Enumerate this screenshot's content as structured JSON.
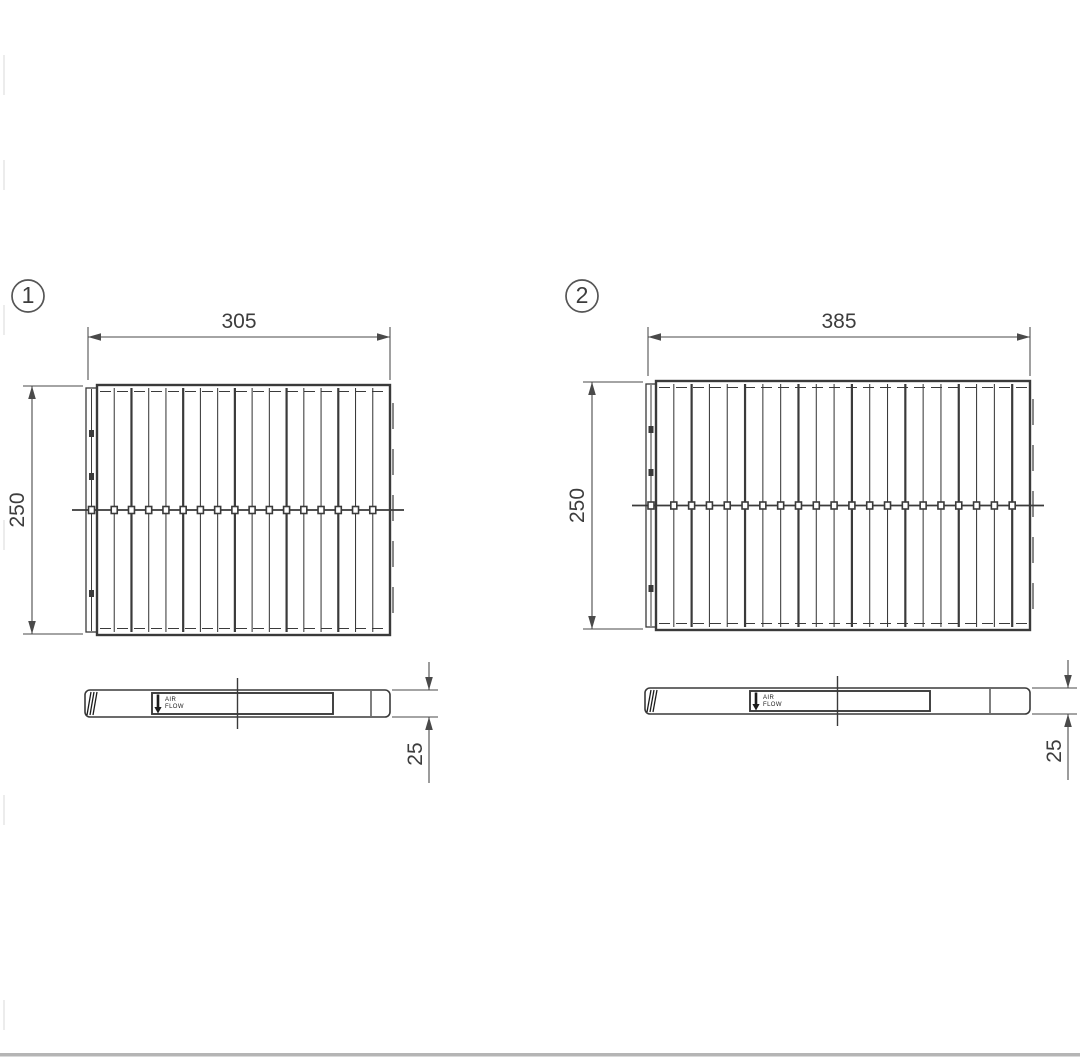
{
  "figure": {
    "parts": [
      {
        "number": "1",
        "width_dim": "305",
        "height_dim": "250",
        "thickness_dim": "25",
        "airflow_line1": "AIR",
        "airflow_line2": "FLOW"
      },
      {
        "number": "2",
        "width_dim": "385",
        "height_dim": "250",
        "thickness_dim": "25",
        "airflow_line1": "AIR",
        "airflow_line2": "FLOW"
      }
    ]
  },
  "colors": {
    "drawing_line": "#3a3a3a",
    "dimension_line": "#4a4a4a",
    "dimension_text": "#3d3d3d",
    "airflow_ink": "#1c1c1c",
    "background": "#ffffff",
    "footer_rule": "#b5b5b5",
    "scan_artifact": "#dcdcdc"
  }
}
